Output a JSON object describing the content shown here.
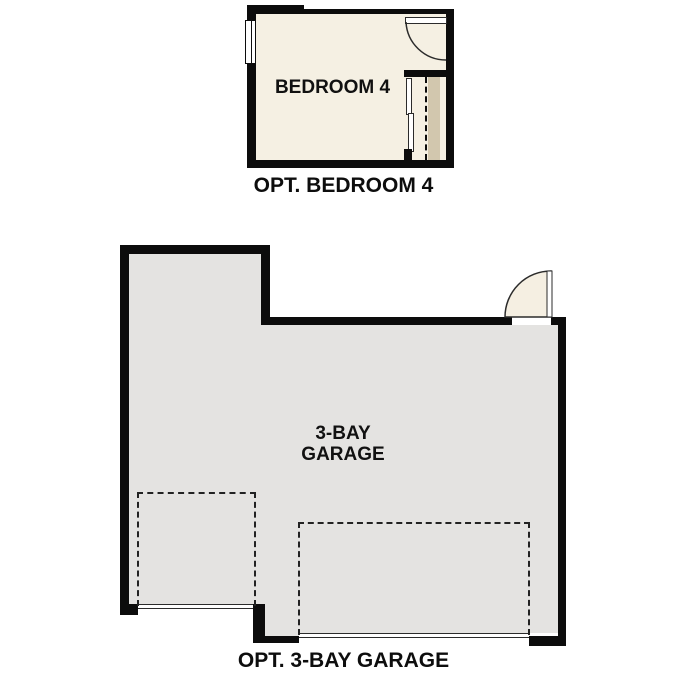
{
  "colors": {
    "wall": "#0c0c0c",
    "line": "#2b2b2b",
    "bedroom_floor": "#f5f0e3",
    "garage_floor": "#e4e3e1",
    "closet_shelf": "#d2c7ae",
    "door_fill": "#f5efe2"
  },
  "bedroom_plan": {
    "room_label": "BEDROOM 4",
    "caption": "OPT. BEDROOM 4"
  },
  "garage_plan": {
    "room_label_lines": [
      "3-BAY",
      "GARAGE"
    ],
    "caption": "OPT. 3-BAY GARAGE"
  }
}
